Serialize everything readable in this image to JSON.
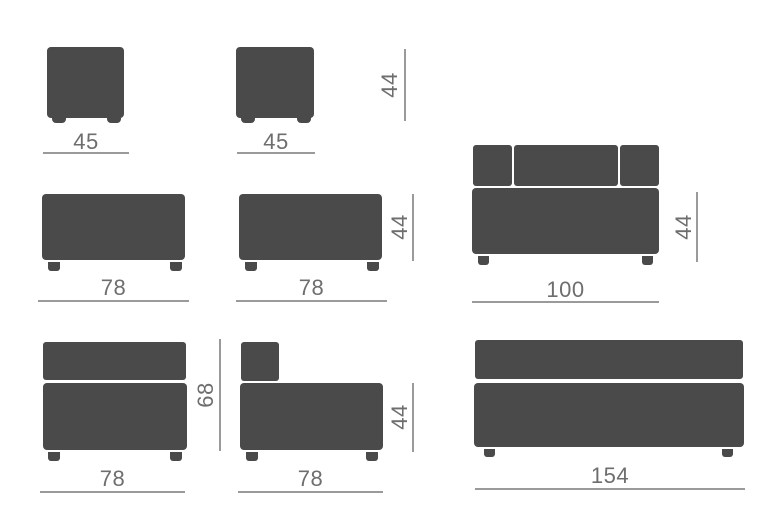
{
  "diagram": {
    "description_colors": {
      "background": "#ffffff",
      "shape_fill": "#4a4a4a",
      "line_color": "#9a9a9a",
      "text_color": "#6e6e6e"
    },
    "figures": [
      {
        "id": "pouf-left",
        "type": "pouf",
        "width_label": "45"
      },
      {
        "id": "pouf-right",
        "type": "pouf",
        "width_label": "45"
      },
      {
        "id": "pouf-height",
        "type": "height-dimension",
        "height_label": "44"
      },
      {
        "id": "bench-left",
        "type": "bench",
        "width_label": "78"
      },
      {
        "id": "bench-right",
        "type": "bench",
        "width_label": "78",
        "height_label": "44"
      },
      {
        "id": "sofa",
        "type": "sofa-with-back",
        "width_label": "100",
        "height_label": "44"
      },
      {
        "id": "module-back",
        "type": "module-with-back",
        "width_label": "78",
        "height_label": "68"
      },
      {
        "id": "module-corner",
        "type": "corner-module",
        "width_label": "78",
        "height_label": "44"
      },
      {
        "id": "bench-long",
        "type": "long-bench",
        "width_label": "154"
      }
    ]
  }
}
